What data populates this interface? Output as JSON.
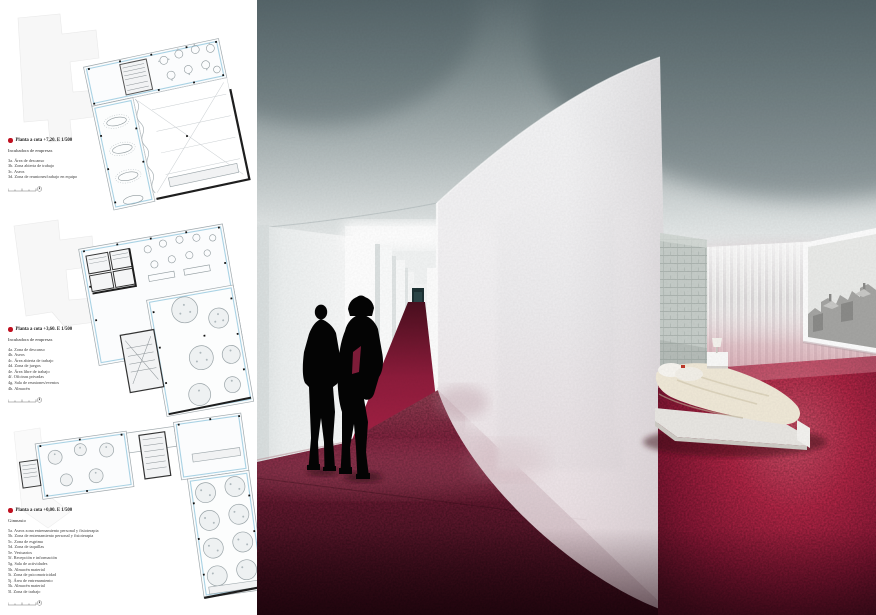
{
  "board": {
    "kind": "architectural presentation panel",
    "left_panel": "floor plans with legends",
    "right_panel": "interior render"
  },
  "colors": {
    "marker_red": "#c01020",
    "plan_outline_blue": "#a9d2e4",
    "carpet_dark": "#57152a",
    "carpet_main": "#8c1736",
    "carpet_light_pool": "#d94868",
    "ceiling_dark": "#5a696d",
    "frosted_glass": "#f2eff1",
    "silhouette": "#000000"
  },
  "legends": [
    {
      "title": "Planta a cota +7,20. E 1/500",
      "subtitle": "Incubadora de empresas",
      "items": [
        "3a. Área de descanso",
        "3b. Zona abierta de trabajo",
        "3c. Aseos",
        "3d. Zona de reuniones/trabajo en equipo"
      ]
    },
    {
      "title": "Planta a cota +3,60. E 1/500",
      "subtitle": "Incubadora de empresas",
      "items": [
        "4a. Zona de descanso",
        "4b. Aseos",
        "4c. Área abierta de trabajo",
        "4d. Zona de juegos",
        "4e. Área libre de trabajo",
        "4f. Oficinas privadas",
        "4g. Sala de reuniones/eventos",
        "4h. Almacén"
      ]
    },
    {
      "title": "Planta a cota +0,00. E 1/500",
      "subtitle": "Gimnasio",
      "items": [
        "5a. Aseos zona entrenamiento personal y fisioterapia",
        "5b. Zona de entrenamiento personal y fisioterapia",
        "5c. Zona de esgrima",
        "5d. Zona de taquillas",
        "5e. Vestuarios",
        "5f. Recepción e información",
        "5g. Sala de actividades",
        "5h. Almacén material",
        "5i. Zona de psicomotricidad",
        "5j. Área de entrenamiento",
        "5k. Almacén material",
        "5l. Zona de trabajo"
      ]
    }
  ]
}
